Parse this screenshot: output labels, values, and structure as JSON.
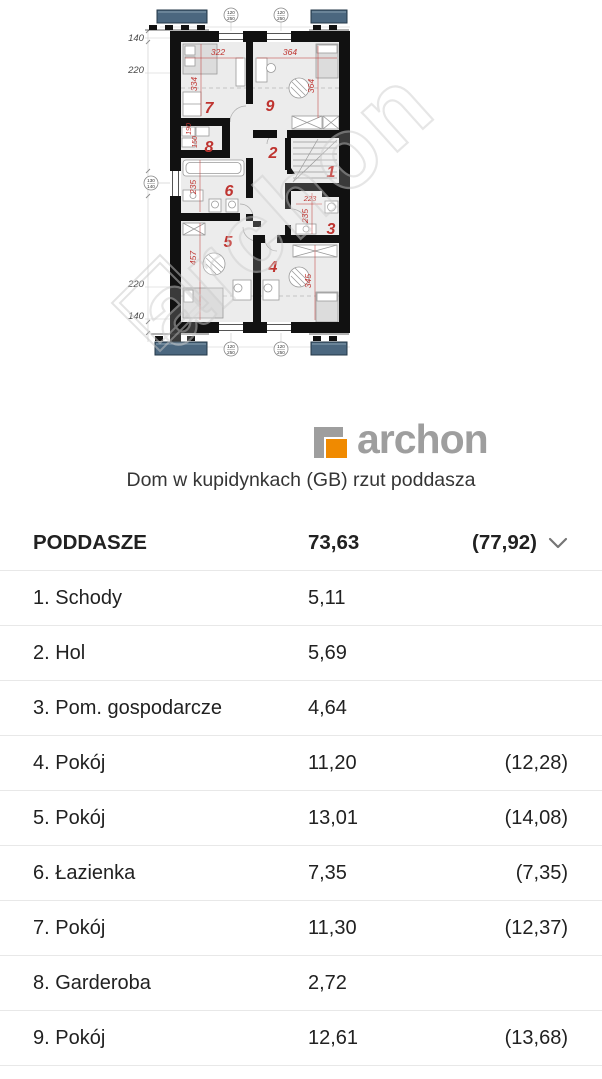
{
  "plan": {
    "watermark": "archon",
    "room_numbers": {
      "room1": "1",
      "room2": "2",
      "room3": "3",
      "room4": "4",
      "room5": "5",
      "room6": "6",
      "room7": "7",
      "room8": "8",
      "room9": "9"
    },
    "dimensions": {
      "d322": "322",
      "d364_top": "364",
      "d334": "334",
      "d364_right": "364",
      "d190": "190",
      "d150": "150",
      "d235_bath": "235",
      "d223": "223",
      "d235_util": "235",
      "d457": "457",
      "d345": "345"
    },
    "side_dims": [
      "140",
      "220",
      "220",
      "140"
    ],
    "window_marker": {
      "num": "120",
      "den": "250"
    },
    "left_marker": {
      "num": "130",
      "den": "140"
    }
  },
  "logo": {
    "text": "archon"
  },
  "title": "Dom w kupidynkach (GB) rzut poddasza",
  "table": {
    "header": {
      "name": "PODDASZE",
      "area": "73,63",
      "area_secondary": "(77,92)"
    },
    "rows": [
      {
        "name": "1. Schody",
        "area": "5,11",
        "area_secondary": ""
      },
      {
        "name": "2. Hol",
        "area": "5,69",
        "area_secondary": ""
      },
      {
        "name": "3. Pom. gospodarcze",
        "area": "4,64",
        "area_secondary": ""
      },
      {
        "name": "4. Pokój",
        "area": "11,20",
        "area_secondary": "(12,28)"
      },
      {
        "name": "5. Pokój",
        "area": "13,01",
        "area_secondary": "(14,08)"
      },
      {
        "name": "6. Łazienka",
        "area": "7,35",
        "area_secondary": "(7,35)"
      },
      {
        "name": "7. Pokój",
        "area": "11,30",
        "area_secondary": "(12,37)"
      },
      {
        "name": "8. Garderoba",
        "area": "2,72",
        "area_secondary": ""
      },
      {
        "name": "9. Pokój",
        "area": "12,61",
        "area_secondary": "(13,68)"
      }
    ]
  }
}
